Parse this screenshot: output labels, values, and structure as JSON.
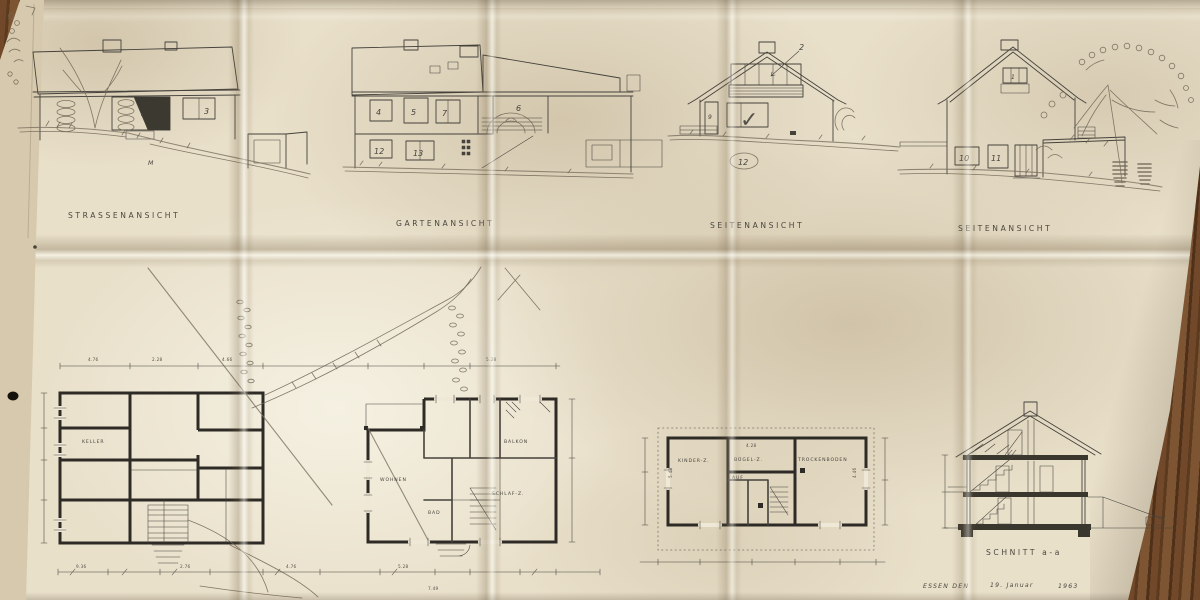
{
  "captions": {
    "street": "STRASSENANSICHT",
    "garden": "GARTENANSICHT",
    "side_a": "SEITENANSICHT",
    "side_b": "SEITENANSICHT",
    "section": "SCHNITT  a-a"
  },
  "footer": {
    "place": "ESSEN DEN",
    "date": "19. Januar",
    "year": "1963"
  },
  "window_numbers": {
    "w1": "1",
    "w2": "2",
    "w3": "3",
    "w4": "4",
    "w5": "5",
    "w6": "6",
    "w7": "7",
    "w9": "9",
    "w10": "10",
    "w11": "11",
    "w12": "12",
    "w13": "13"
  },
  "plan_rooms": {
    "keller": "KELLER",
    "wohnen": "WOHNEN",
    "schlaf": "SCHLAF-Z.",
    "balkon": "BALKON",
    "bad": "BAD",
    "kinder": "KINDER-Z.",
    "buegel": "BÜGEL-Z.",
    "auf": "AUF",
    "trocken": "TROCKENBODEN"
  },
  "annotations": {
    "elev12": "12",
    "m_mark": "M",
    "check": "✓"
  },
  "dimensions": {
    "d1": "9.36",
    "d2": "2.76",
    "d3": "4.76",
    "d4": "5.28",
    "d5": "2.28",
    "d6": "4.66",
    "d7": "4.28",
    "d8": "5.48",
    "d9": "4.46",
    "d10": "7.49"
  },
  "colors": {
    "paper": "#ebe3cf",
    "ink": "#45423c",
    "pencil": "#6e6555",
    "wood": "#6b4526"
  }
}
